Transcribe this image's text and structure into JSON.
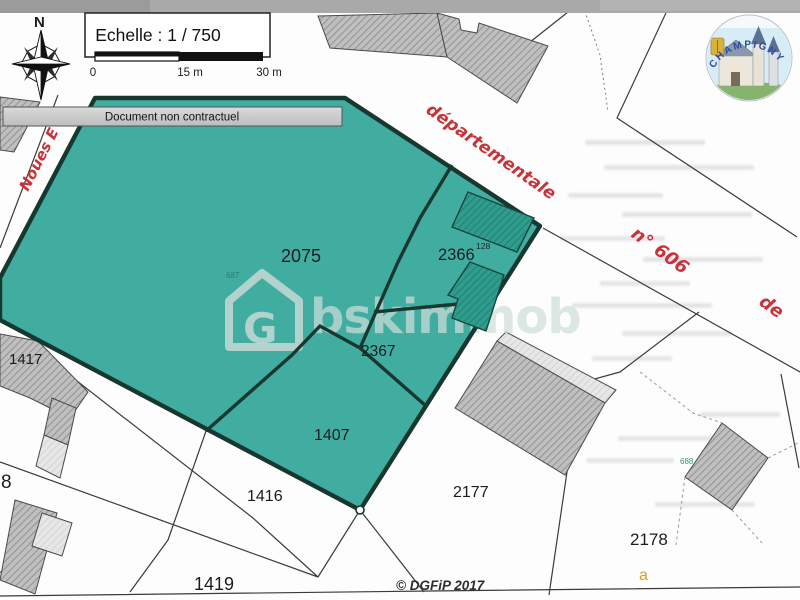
{
  "document": {
    "scale_title": "Echelle : 1 / 750",
    "scale_ticks": [
      "0",
      "15 m",
      "30 m"
    ],
    "disclaimer": "Document non contractuel",
    "compass_label": "N",
    "copyright": "© DGFiP 2017",
    "watermark": {
      "brand": "bskimmob",
      "monogram": "G"
    },
    "town_seal": "CHAMPIGNY"
  },
  "roads": {
    "noues": "Noues E",
    "departementale": "départementale",
    "number": "n° 606",
    "de": "de"
  },
  "parcels": [
    {
      "label": "2075"
    },
    {
      "label": "2366"
    },
    {
      "label": "2367"
    },
    {
      "label": "1407"
    },
    {
      "label": "1417"
    },
    {
      "label": "1416"
    },
    {
      "label": "1419"
    },
    {
      "label": "2177"
    },
    {
      "label": "2178"
    },
    {
      "label": "8"
    }
  ],
  "sub_labels": {
    "a": "a",
    "n687": "687",
    "n128": "128",
    "n688": "688"
  },
  "colors": {
    "parcel_teal": "#41ada0",
    "outline_dark": "#17372f",
    "road_red": "#c8333a",
    "building_gray": "#bfbfbf",
    "accent_orange": "#e39a1e"
  }
}
